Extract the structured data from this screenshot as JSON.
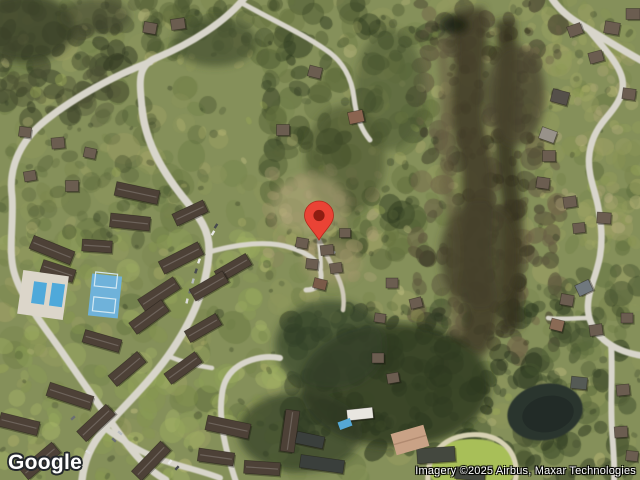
{
  "map": {
    "view": "Satellite",
    "marker": {
      "name": "location-pin",
      "color": "#EA4335",
      "outline_color": "#B3271B",
      "dot_color": "#8F1D12"
    }
  },
  "branding": {
    "logo_text": "Google"
  },
  "attribution": {
    "text": "Imagery ©2025 Airbus, Maxar Technologies"
  }
}
